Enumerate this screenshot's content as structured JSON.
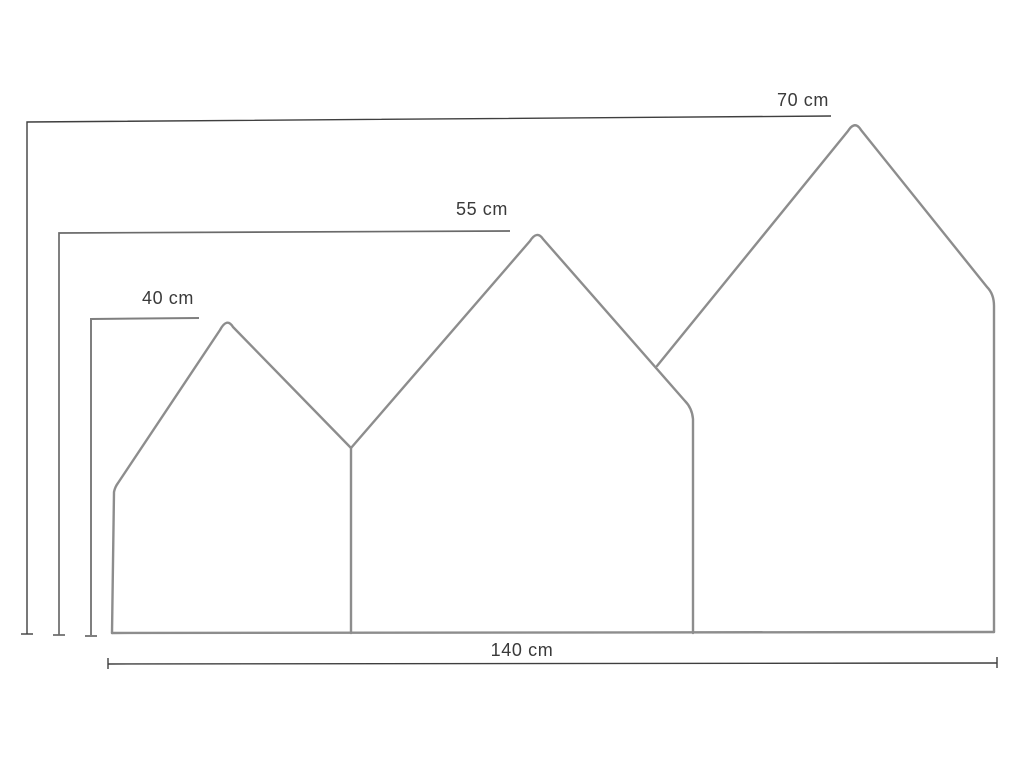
{
  "figure": {
    "type": "dimension-diagram",
    "description": "Line drawing of three adjoining house-shaped panels with height and width dimension lines",
    "units": "cm",
    "dimensions": {
      "small_panel_height": {
        "value": 40,
        "unit": "cm",
        "label": "40 cm"
      },
      "medium_panel_height": {
        "value": 55,
        "unit": "cm",
        "label": "55 cm"
      },
      "large_panel_height": {
        "value": 70,
        "unit": "cm",
        "label": "70 cm"
      },
      "total_width": {
        "value": 140,
        "unit": "cm",
        "label": "140 cm"
      }
    },
    "colors": {
      "background": "#ffffff",
      "outline": "#8d8d8d",
      "dimension_line": "#3f3f3f",
      "dimension_line_medium": "#6a6a6a",
      "dimension_line_soft": "#7f7f7f",
      "label_text": "#3a3a3a"
    }
  }
}
